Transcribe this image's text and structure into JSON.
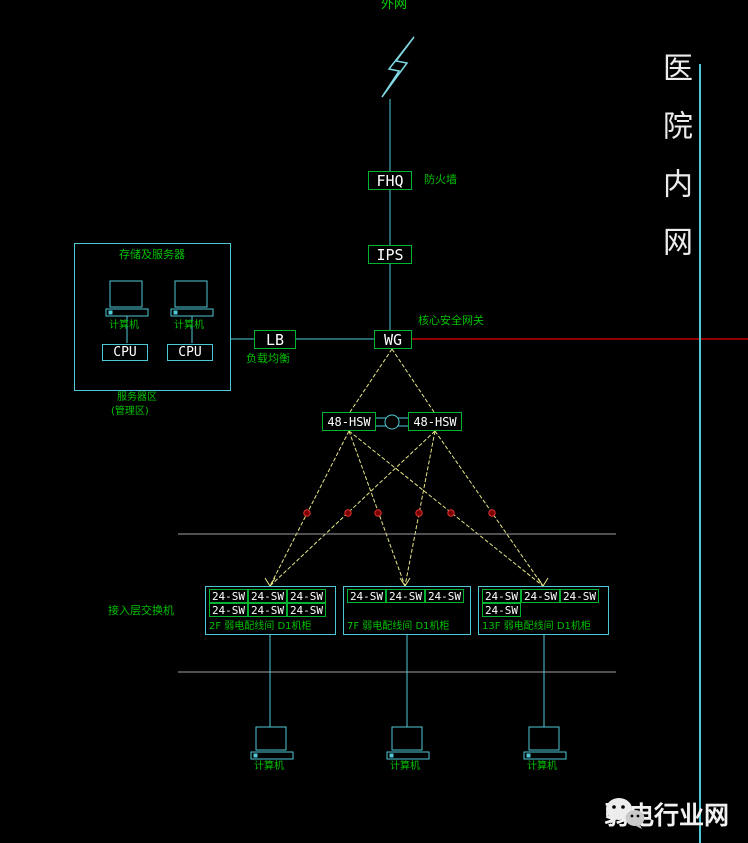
{
  "top": {
    "clipped_label": "外网"
  },
  "right_banner": {
    "text": "医院内网"
  },
  "firewall": {
    "label": "FHQ",
    "annotation": "防火墙"
  },
  "ips": {
    "label": "IPS"
  },
  "gateway": {
    "label": "WG",
    "annotation": "核心安全网关"
  },
  "load_balancer": {
    "label": "LB",
    "annotation": "负载均衡"
  },
  "server_zone": {
    "title": "存储及服务器",
    "computer1": "计算机",
    "computer2": "计算机",
    "cpu1": "CPU",
    "cpu2": "CPU",
    "caption1": "服务器区",
    "caption2": "(管理区)"
  },
  "core_switch_left": {
    "label": "48-HSW"
  },
  "core_switch_right": {
    "label": "48-HSW"
  },
  "access_layer_label": "接入层交换机",
  "switch_groups": [
    {
      "caption": "2F 弱电配线间 D1机柜",
      "rows": [
        [
          "24-SW",
          "24-SW",
          "24-SW"
        ],
        [
          "24-SW",
          "24-SW",
          "24-SW"
        ]
      ]
    },
    {
      "caption": "7F 弱电配线间 D1机柜",
      "rows": [
        [
          "24-SW",
          "24-SW",
          "24-SW"
        ]
      ]
    },
    {
      "caption": "13F 弱电配线间 D1机柜",
      "rows": [
        [
          "24-SW",
          "24-SW",
          "24-SW"
        ],
        [
          "24-SW"
        ]
      ]
    }
  ],
  "terminals": [
    {
      "label": "计算机"
    },
    {
      "label": "计算机"
    },
    {
      "label": "计算机"
    }
  ],
  "watermark": {
    "text": "弱电行业网"
  },
  "colors": {
    "cyan": "#4fc8d6",
    "green": "#00c000",
    "yellow": "#e6e68a",
    "red": "#c00000",
    "gray": "#a0a0a0",
    "white": "#ffffff"
  }
}
